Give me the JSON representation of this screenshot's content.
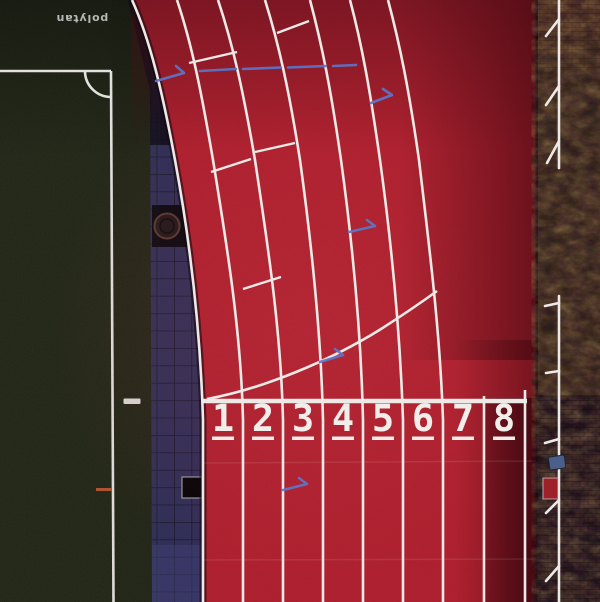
{
  "brand": {
    "label": "polytan"
  },
  "track": {
    "lane_numbers": [
      "1",
      "2",
      "3",
      "4",
      "5",
      "6",
      "7",
      "8"
    ]
  },
  "colors": {
    "track_red": "#b22231",
    "track_red_deep": "#4d0d17",
    "field_green": "#232719",
    "walkway_navy": "#2e2d52",
    "walkway_tile_light": "#45447c",
    "ground_brown": "#3d2c20",
    "ground_brown_dark": "#241720",
    "line_white": "#ece9e6",
    "number_white": "#f0edea",
    "arrow_blue": "#5b76c9",
    "marker_orange": "#b0532f",
    "object_red": "#9e2129",
    "object_blue": "#4a5f8a",
    "brand_text": "#d9d9d9"
  }
}
